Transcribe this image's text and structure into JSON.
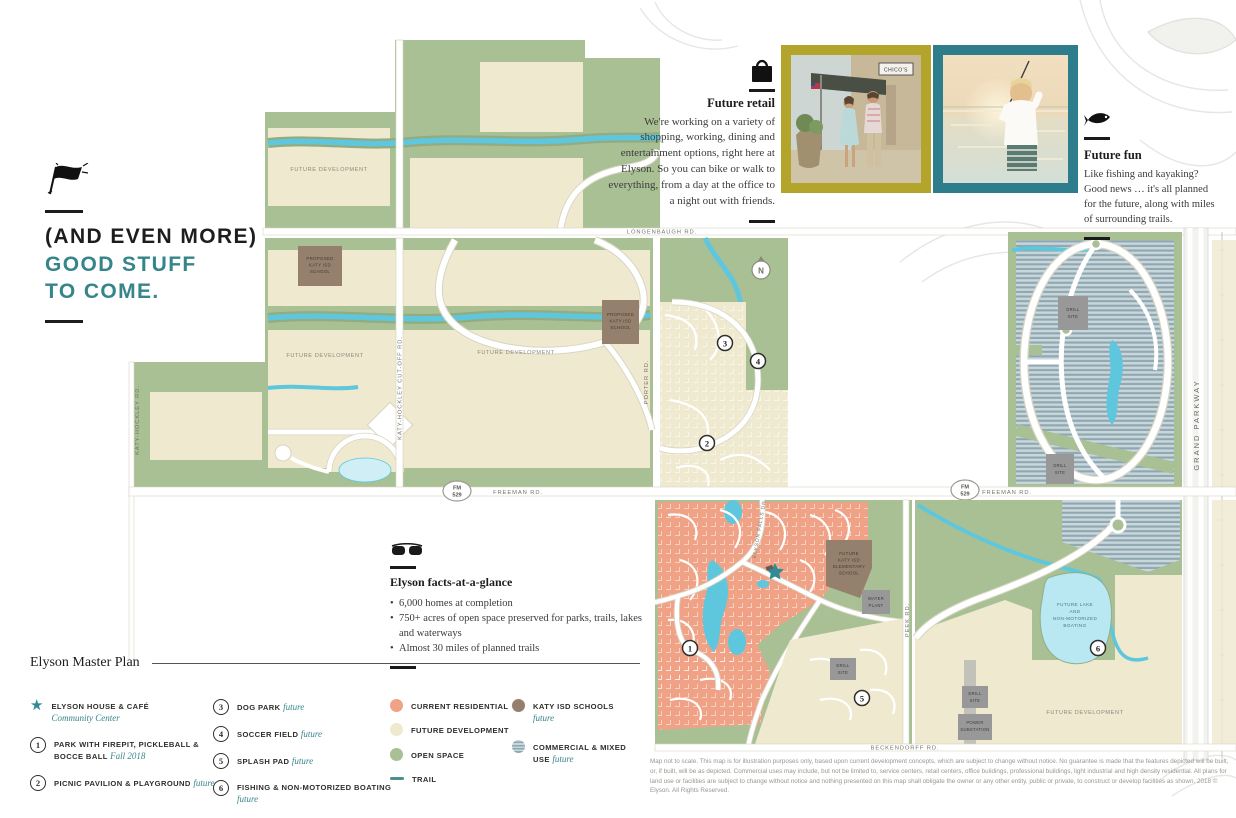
{
  "headline": {
    "line1": "(AND EVEN MORE)",
    "line2": "GOOD STUFF",
    "line3": "TO COME."
  },
  "future_retail": {
    "title": "Future retail",
    "body": "We're working on a variety of shopping, working, dining and entertainment options, right here at Elyson. So you can bike or walk to everything, from a day at the office to a night out with friends."
  },
  "future_fun": {
    "title": "Future fun",
    "body": "Like fishing and kayaking? Good news … it's all planned for the future, along with miles of surrounding trails."
  },
  "photos": {
    "photo1_alt": "couple walking past shops",
    "photo2_alt": "boy fishing at lake",
    "sign": "CHICO'S"
  },
  "facts": {
    "title": "Elyson facts-at-a-glance",
    "bullets": [
      "6,000 homes at completion",
      "750+ acres of open space preserved for parks, trails, lakes and waterways",
      "Almost 30 miles of planned trails"
    ]
  },
  "legend": {
    "title": "Elyson Master Plan",
    "star_item": {
      "label": "ELYSON HOUSE & CAFÉ",
      "sub": "Community Center"
    },
    "numbered": [
      {
        "num": "1",
        "label": "PARK WITH FIREPIT, PICKLEBALL & BOCCE BALL",
        "note": "Fall 2018"
      },
      {
        "num": "2",
        "label": "PICNIC PAVILION & PLAYGROUND",
        "note": "future"
      },
      {
        "num": "3",
        "label": "DOG PARK",
        "note": "future"
      },
      {
        "num": "4",
        "label": "SOCCER FIELD",
        "note": "future"
      },
      {
        "num": "5",
        "label": "SPLASH PAD",
        "note": "future"
      },
      {
        "num": "6",
        "label": "FISHING & NON-MOTORIZED BOATING",
        "note": "future"
      }
    ],
    "swatches": [
      {
        "label": "CURRENT RESIDENTIAL",
        "color": "#f0a287",
        "type": "solid"
      },
      {
        "label": "FUTURE DEVELOPMENT",
        "color": "#efe9d0",
        "type": "solid"
      },
      {
        "label": "OPEN SPACE",
        "color": "#a9c095",
        "type": "solid"
      },
      {
        "label": "TRAIL",
        "color": "#4b8f8f",
        "type": "dash"
      },
      {
        "label": "KATY ISD SCHOOLS",
        "note": "future",
        "color": "#94806d",
        "type": "solid"
      },
      {
        "label": "COMMERCIAL & MIXED USE",
        "note": "future",
        "color": "#8ea7b2",
        "type": "stripes"
      }
    ]
  },
  "map": {
    "compass": "N",
    "roads": {
      "longenbaugh": "LONGENBAUGH RD.",
      "freeman": "FREEMAN RD.",
      "beckendorff": "BECKENDORFF RD.",
      "grand_parkway": "GRAND PARKWAY",
      "katy_hockley": "KATY-HOCKLEY RD.",
      "katy_hockley_cutoff": "KATY-HOCKLEY CUT-OFF RD.",
      "porter": "PORTER RD.",
      "peek": "PEEK RD.",
      "elyson_falls": "ELYSON FALLS DR.",
      "fm": "FM",
      "fm_num": "529"
    },
    "labels": {
      "future_development": "FUTURE DEVELOPMENT",
      "proposed_school": [
        "PROPOSED",
        "KATY ISD",
        "SCHOOL"
      ],
      "future_elementary": [
        "FUTURE",
        "KATY ISD",
        "ELEMENTARY",
        "SCHOOL"
      ],
      "water_plant": [
        "WATER",
        "PLANT"
      ],
      "drill_site": [
        "DRILL",
        "SITE"
      ],
      "power_substation": [
        "POWER",
        "SUBSTATION"
      ],
      "future_lake": [
        "FUTURE LAKE",
        "AND",
        "NON-MOTORIZED",
        "BOATING"
      ]
    },
    "markers": {
      "m1": "1",
      "m2": "2",
      "m3": "3",
      "m4": "4",
      "m5": "5",
      "m6": "6"
    },
    "area_colors": {
      "open_space": "#a9c095",
      "future_development": "#efe9d0",
      "current_residential": "#f0a287",
      "water": "#5ec7dd",
      "schools": "#94806d",
      "commercial_base": "#c9d6da",
      "commercial_stripe": "#8ea7b2"
    }
  },
  "disclaimer": "Map not to scale. This map is for illustration purposes only, based upon current development concepts, which are subject to change without notice. No guarantee is made that the features depicted will be built, or, if built, will be as depicted. Commercial uses may include, but not be limited to, service centers, retail centers, office buildings, professional buildings, light industrial and high density residential. All plans for land use or facilities are subject to change without notice and nothing presented on this map shall obligate the owner or any other entity, public or private, to construct or develop facilities as shown. 2018 © Elyson. All Rights Reserved."
}
